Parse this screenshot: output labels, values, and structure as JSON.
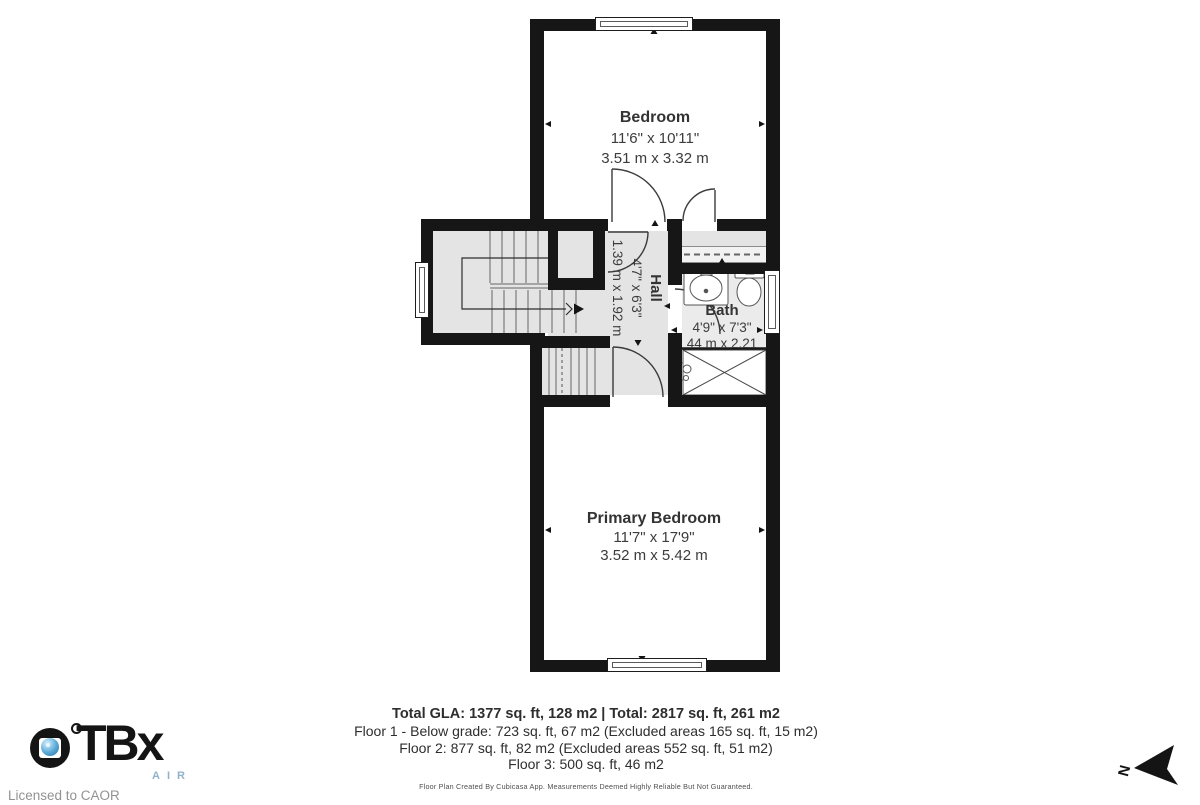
{
  "rooms": {
    "bedroom": {
      "name": "Bedroom",
      "imperial": "11'6\" x 10'11\"",
      "metric": "3.51 m x 3.32 m"
    },
    "hall": {
      "name": "Hall",
      "imperial": "4'7\" x 6'3\"",
      "metric": "1.39 m x 1.92 m"
    },
    "bath": {
      "name": "Bath",
      "imperial": "4'9\" x 7'3\"",
      "metric": "44 m x 2.21"
    },
    "primary": {
      "name": "Primary Bedroom",
      "imperial": "11'7\" x 17'9\"",
      "metric": "3.52 m x 5.42 m"
    }
  },
  "footer": {
    "total_line": "Total GLA: 1377 sq. ft, 128 m2 | Total: 2817 sq. ft, 261 m2",
    "floor1": "Floor 1 - Below grade: 723 sq. ft, 67 m2 (Excluded areas 165 sq. ft, 15 m2)",
    "floor2": "Floor 2: 877 sq. ft, 82 m2 (Excluded areas 552 sq. ft, 51 m2)",
    "floor3": "Floor 3: 500 sq. ft, 46 m2",
    "disclaimer": "Floor Plan Created By Cubicasa App. Measurements Deemed Highly Reliable But Not Guaranteed."
  },
  "branding": {
    "logo_text": "TBx",
    "logo_sub": "AIR",
    "license": "Licensed to CAOR"
  },
  "compass": {
    "north_label": "N"
  },
  "icons": {
    "camera_lens": "camera-lens-icon",
    "north_arrow": "north-arrow-icon",
    "sink": "sink-icon",
    "toilet": "toilet-icon",
    "shower": "shower-icon"
  },
  "colors": {
    "wall": "#161616",
    "floor_gray": "#e4e4e4",
    "lens_blue": "#57a7d4",
    "air_blue": "#8fb3c9"
  }
}
